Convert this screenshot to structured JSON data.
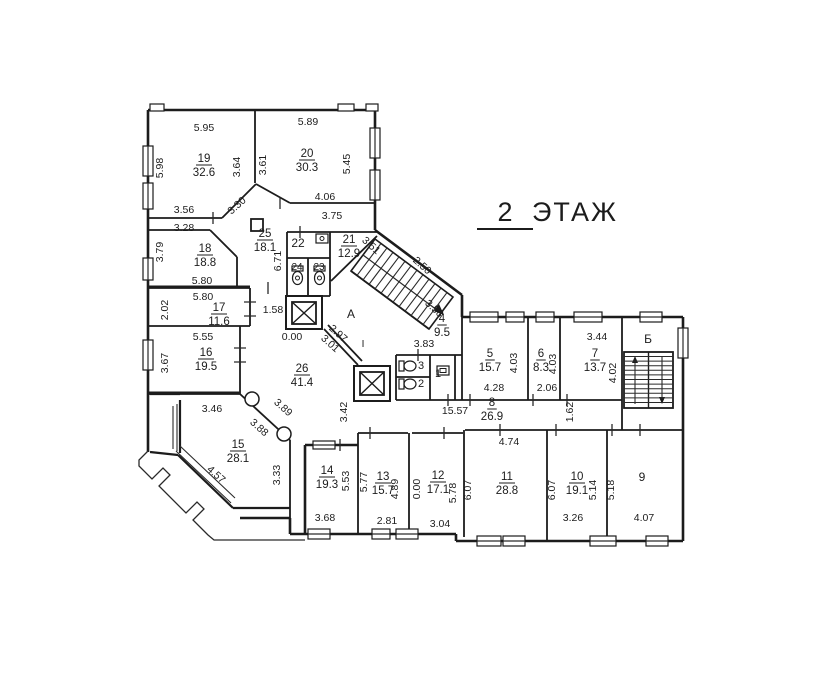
{
  "title": {
    "floor_number": "2",
    "floor_word": "ЭТАЖ"
  },
  "colors": {
    "ink": "#1c1c1c",
    "background": "#ffffff"
  },
  "rooms": [
    {
      "number": "19",
      "area": "32.6",
      "x": 204,
      "y": 162
    },
    {
      "number": "20",
      "area": "30.3",
      "x": 307,
      "y": 157
    },
    {
      "number": "18",
      "area": "18.8",
      "x": 205,
      "y": 252
    },
    {
      "number": "25",
      "area": "18.1",
      "x": 265,
      "y": 237
    },
    {
      "number": "21",
      "area": "12.9",
      "x": 349,
      "y": 243
    },
    {
      "number": "17",
      "area": "11.6",
      "x": 219,
      "y": 311
    },
    {
      "number": "16",
      "area": "19.5",
      "x": 206,
      "y": 356
    },
    {
      "number": "26",
      "area": "41.4",
      "x": 302,
      "y": 372
    },
    {
      "number": "15",
      "area": "28.1",
      "x": 238,
      "y": 448
    },
    {
      "number": "4",
      "area": "9.5",
      "x": 442,
      "y": 322
    },
    {
      "number": "5",
      "area": "15.7",
      "x": 490,
      "y": 357
    },
    {
      "number": "6",
      "area": "8.3",
      "x": 541,
      "y": 357
    },
    {
      "number": "7",
      "area": "13.7",
      "x": 595,
      "y": 357
    },
    {
      "number": "8",
      "area": "26.9",
      "x": 492,
      "y": 406
    },
    {
      "number": "14",
      "area": "19.3",
      "x": 327,
      "y": 474
    },
    {
      "number": "13",
      "area": "15.7",
      "x": 383,
      "y": 480
    },
    {
      "number": "12",
      "area": "17.1",
      "x": 438,
      "y": 479
    },
    {
      "number": "11",
      "area": "28.8",
      "x": 507,
      "y": 480
    },
    {
      "number": "10",
      "area": "19.1",
      "x": 577,
      "y": 480
    }
  ],
  "labels": [
    {
      "text": "22",
      "x": 298,
      "y": 247,
      "size": 12
    },
    {
      "text": "24",
      "x": 297,
      "y": 270,
      "size": 10
    },
    {
      "text": "23",
      "x": 319,
      "y": 270,
      "size": 10
    },
    {
      "text": "3",
      "x": 421,
      "y": 369,
      "size": 11
    },
    {
      "text": "2",
      "x": 421,
      "y": 387,
      "size": 11
    },
    {
      "text": "1",
      "x": 438,
      "y": 377,
      "size": 11
    },
    {
      "text": "9",
      "x": 642,
      "y": 481,
      "size": 12
    },
    {
      "text": "А",
      "x": 351,
      "y": 318,
      "size": 12
    },
    {
      "text": "Б",
      "x": 648,
      "y": 343,
      "size": 12
    },
    {
      "text": "I",
      "x": 363,
      "y": 347,
      "size": 10
    }
  ],
  "dimensions": [
    {
      "text": "5.95",
      "x": 204,
      "y": 131,
      "rot": 0
    },
    {
      "text": "5.89",
      "x": 308,
      "y": 125,
      "rot": 0
    },
    {
      "text": "5.98",
      "x": 163,
      "y": 168,
      "rot": -90
    },
    {
      "text": "3.64",
      "x": 240,
      "y": 167,
      "rot": -90
    },
    {
      "text": "3.61",
      "x": 266,
      "y": 165,
      "rot": -90
    },
    {
      "text": "5.45",
      "x": 350,
      "y": 164,
      "rot": -90
    },
    {
      "text": "3.56",
      "x": 184,
      "y": 213,
      "rot": 0
    },
    {
      "text": "3.28",
      "x": 184,
      "y": 231,
      "rot": 0
    },
    {
      "text": "3.30",
      "x": 239,
      "y": 208,
      "rot": -42
    },
    {
      "text": "4.06",
      "x": 325,
      "y": 200,
      "rot": 0
    },
    {
      "text": "3.75",
      "x": 332,
      "y": 219,
      "rot": 0
    },
    {
      "text": "3.79",
      "x": 163,
      "y": 252,
      "rot": -90
    },
    {
      "text": "5.80",
      "x": 202,
      "y": 284,
      "rot": 0
    },
    {
      "text": "5.80",
      "x": 203,
      "y": 300,
      "rot": 0
    },
    {
      "text": "2.02",
      "x": 168,
      "y": 310,
      "rot": -90
    },
    {
      "text": "6.71",
      "x": 281,
      "y": 261,
      "rot": -90
    },
    {
      "text": "3.51",
      "x": 369,
      "y": 248,
      "rot": 42
    },
    {
      "text": "1.58",
      "x": 273,
      "y": 313,
      "rot": 0
    },
    {
      "text": "0.00",
      "x": 292,
      "y": 340,
      "rot": 0
    },
    {
      "text": "2.97",
      "x": 336,
      "y": 336,
      "rot": 42
    },
    {
      "text": "3.01",
      "x": 328,
      "y": 346,
      "rot": 42
    },
    {
      "text": "2.50",
      "x": 420,
      "y": 268,
      "rot": 42
    },
    {
      "text": "3.58",
      "x": 432,
      "y": 311,
      "rot": 42
    },
    {
      "text": "3.83",
      "x": 424,
      "y": 347,
      "rot": 0
    },
    {
      "text": "3.42",
      "x": 347,
      "y": 412,
      "rot": -90
    },
    {
      "text": "3.46",
      "x": 212,
      "y": 412,
      "rot": 0
    },
    {
      "text": "3.89",
      "x": 281,
      "y": 410,
      "rot": 42
    },
    {
      "text": "3.88",
      "x": 257,
      "y": 430,
      "rot": 42
    },
    {
      "text": "4.57",
      "x": 214,
      "y": 477,
      "rot": 42
    },
    {
      "text": "3.33",
      "x": 280,
      "y": 475,
      "rot": -90
    },
    {
      "text": "5.55",
      "x": 203,
      "y": 340,
      "rot": 0
    },
    {
      "text": "3.67",
      "x": 168,
      "y": 363,
      "rot": -90
    },
    {
      "text": "3.44",
      "x": 597,
      "y": 340,
      "rot": 0
    },
    {
      "text": "4.03",
      "x": 517,
      "y": 363,
      "rot": -90
    },
    {
      "text": "4.03",
      "x": 556,
      "y": 364,
      "rot": -90
    },
    {
      "text": "4.28",
      "x": 494,
      "y": 391,
      "rot": 0
    },
    {
      "text": "2.06",
      "x": 547,
      "y": 391,
      "rot": 0
    },
    {
      "text": "4.02",
      "x": 616,
      "y": 373,
      "rot": -90
    },
    {
      "text": "15.57",
      "x": 455,
      "y": 414,
      "rot": 0
    },
    {
      "text": "1.62",
      "x": 573,
      "y": 412,
      "rot": -90
    },
    {
      "text": "4.74",
      "x": 509,
      "y": 445,
      "rot": 0
    },
    {
      "text": "5.53",
      "x": 349,
      "y": 481,
      "rot": -90
    },
    {
      "text": "3.68",
      "x": 325,
      "y": 521,
      "rot": 0
    },
    {
      "text": "5.77",
      "x": 367,
      "y": 482,
      "rot": -90
    },
    {
      "text": "4.89",
      "x": 398,
      "y": 489,
      "rot": -90
    },
    {
      "text": "2.81",
      "x": 387,
      "y": 524,
      "rot": 0
    },
    {
      "text": "0.00",
      "x": 420,
      "y": 489,
      "rot": -90
    },
    {
      "text": "5.78",
      "x": 456,
      "y": 493,
      "rot": -90
    },
    {
      "text": "3.04",
      "x": 440,
      "y": 527,
      "rot": 0
    },
    {
      "text": "6.07",
      "x": 471,
      "y": 490,
      "rot": -90
    },
    {
      "text": "6.07",
      "x": 555,
      "y": 490,
      "rot": -90
    },
    {
      "text": "5.14",
      "x": 596,
      "y": 490,
      "rot": -90
    },
    {
      "text": "3.26",
      "x": 573,
      "y": 521,
      "rot": 0
    },
    {
      "text": "5.18",
      "x": 614,
      "y": 490,
      "rot": -90
    },
    {
      "text": "4.07",
      "x": 644,
      "y": 521,
      "rot": 0
    }
  ]
}
